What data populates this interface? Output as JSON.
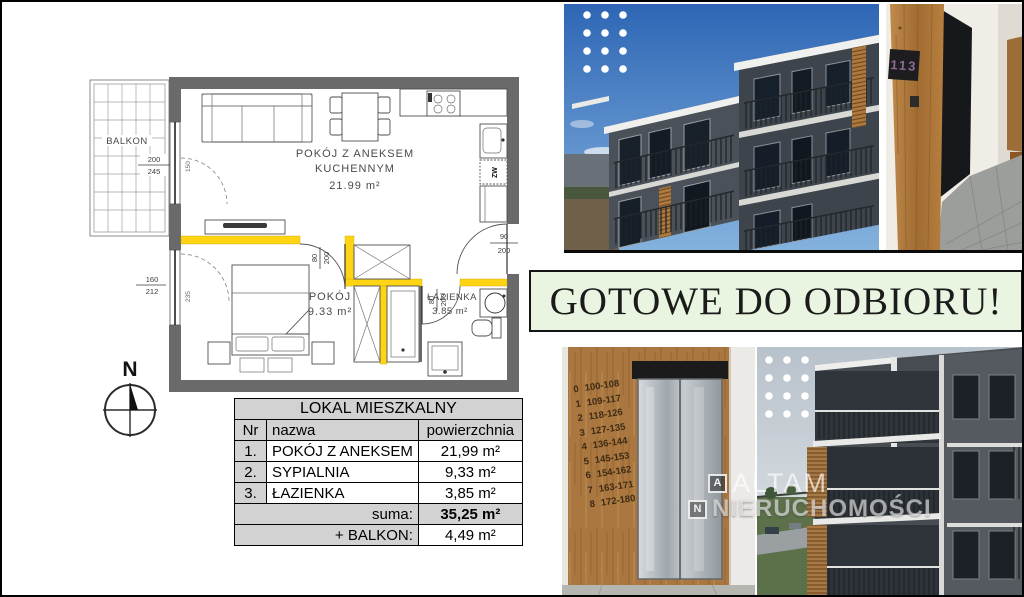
{
  "floor_plan": {
    "balcony_label": "BALKON",
    "living_room": {
      "name_line1": "POKÓJ Z ANEKSEM",
      "name_line2": "KUCHENNYM",
      "area": "21.99 m²"
    },
    "bedroom": {
      "name": "POKÓJ",
      "area": "9.33 m²"
    },
    "bathroom": {
      "name": "ŁAZIENKA",
      "area": "3.85 m²"
    },
    "compass": "N",
    "labels": {
      "cold_water": "ZW"
    },
    "dims": {
      "balcony_door": [
        "200",
        "245"
      ],
      "bedroom_window": [
        "160",
        "212"
      ],
      "bedroom_door": [
        "80",
        "200"
      ],
      "bathroom_door": [
        "80",
        "200"
      ],
      "entry_door": [
        "90",
        "200"
      ],
      "side_note_1": "150",
      "side_note_2": "235"
    },
    "colors": {
      "wall": "#6a6a6a",
      "highlight_wall": "#ffd414"
    }
  },
  "area_table": {
    "title": "LOKAL MIESZKALNY",
    "columns": [
      "Nr",
      "nazwa",
      "powierzchnia"
    ],
    "rows": [
      {
        "nr": "1.",
        "nazwa": "POKÓJ Z ANEKSEM",
        "powierzchnia": "21,99 m²"
      },
      {
        "nr": "2.",
        "nazwa": "SYPIALNIA",
        "powierzchnia": "9,33 m²"
      },
      {
        "nr": "3.",
        "nazwa": "ŁAZIENKA",
        "powierzchnia": "3,85 m²"
      }
    ],
    "summary_rows": [
      {
        "label": "suma:",
        "value": "35,25 m²"
      },
      {
        "label": "+ BALKON:",
        "value": "4,49 m²"
      }
    ]
  },
  "banner": {
    "text": "GOTOWE DO ODBIORU!",
    "bg_color": "#e9f5e0",
    "border_color": "#141414"
  },
  "photos": {
    "door_plaque": "113",
    "elevator_directory": [
      {
        "floor": "0",
        "rooms": "100-108"
      },
      {
        "floor": "1",
        "rooms": "109-117"
      },
      {
        "floor": "2",
        "rooms": "118-126"
      },
      {
        "floor": "3",
        "rooms": "127-135"
      },
      {
        "floor": "4",
        "rooms": "136-144"
      },
      {
        "floor": "5",
        "rooms": "145-153"
      },
      {
        "floor": "6",
        "rooms": "154-162"
      },
      {
        "floor": "7",
        "rooms": "163-171"
      },
      {
        "floor": "8",
        "rooms": "172-180"
      }
    ]
  },
  "watermark": {
    "box_a": "A",
    "box_n": "N",
    "line1": "ALTAM",
    "line2": "NIERUCHOMOŚCI"
  }
}
